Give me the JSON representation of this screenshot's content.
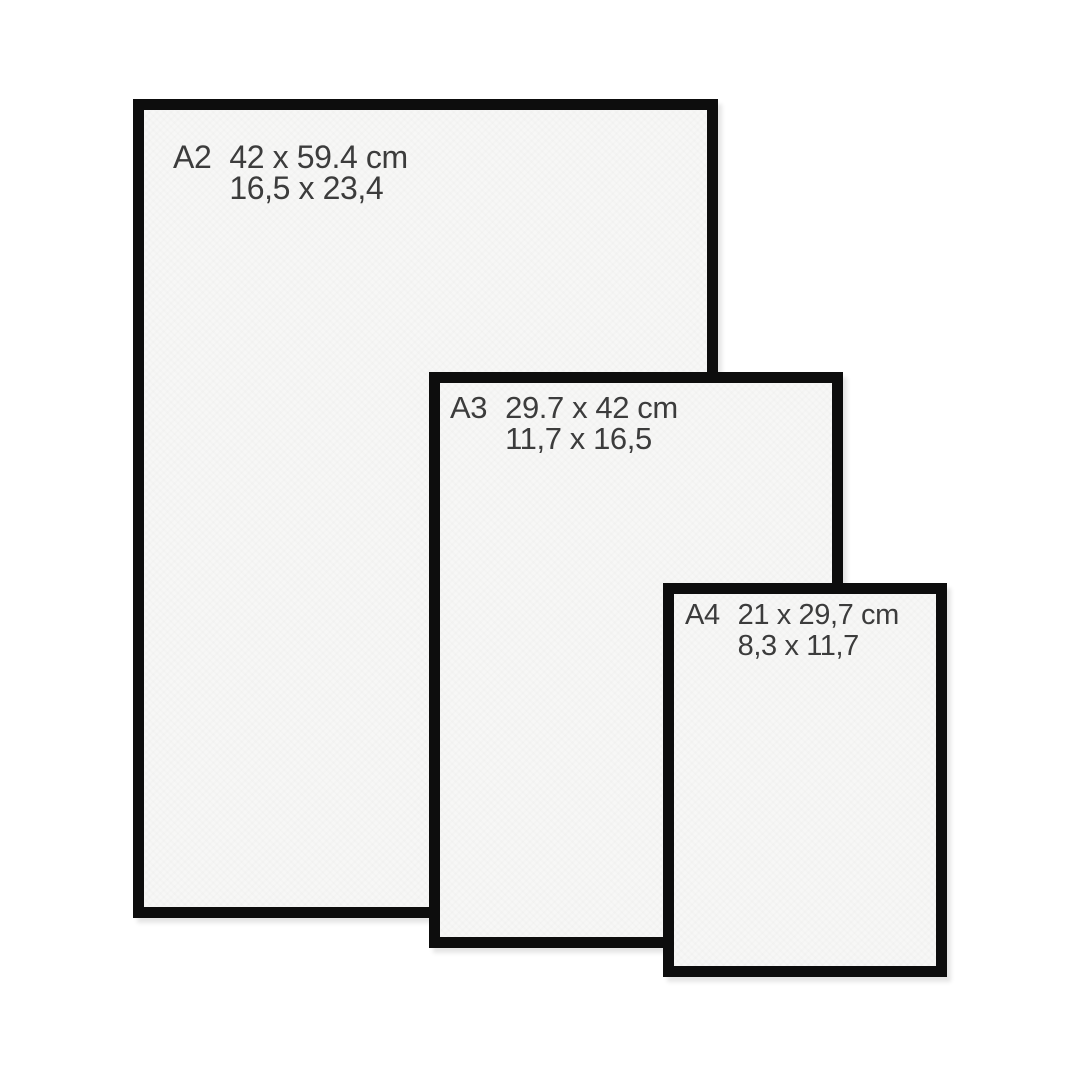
{
  "title": "Paper size comparison frames",
  "colors": {
    "background": "#ffffff",
    "frame_border": "#0d0d0d",
    "frame_interior": "#f7f7f6",
    "text": "#3c3c3c"
  },
  "frames": [
    {
      "name": "A2",
      "size_cm": "42 x 59.4 cm",
      "size_in": "16,5 x 23,4"
    },
    {
      "name": "A3",
      "size_cm": "29.7 x 42 cm",
      "size_in": "11,7 x 16,5"
    },
    {
      "name": "A4",
      "size_cm": "21 x 29,7 cm",
      "size_in": "8,3 x 11,7"
    }
  ]
}
